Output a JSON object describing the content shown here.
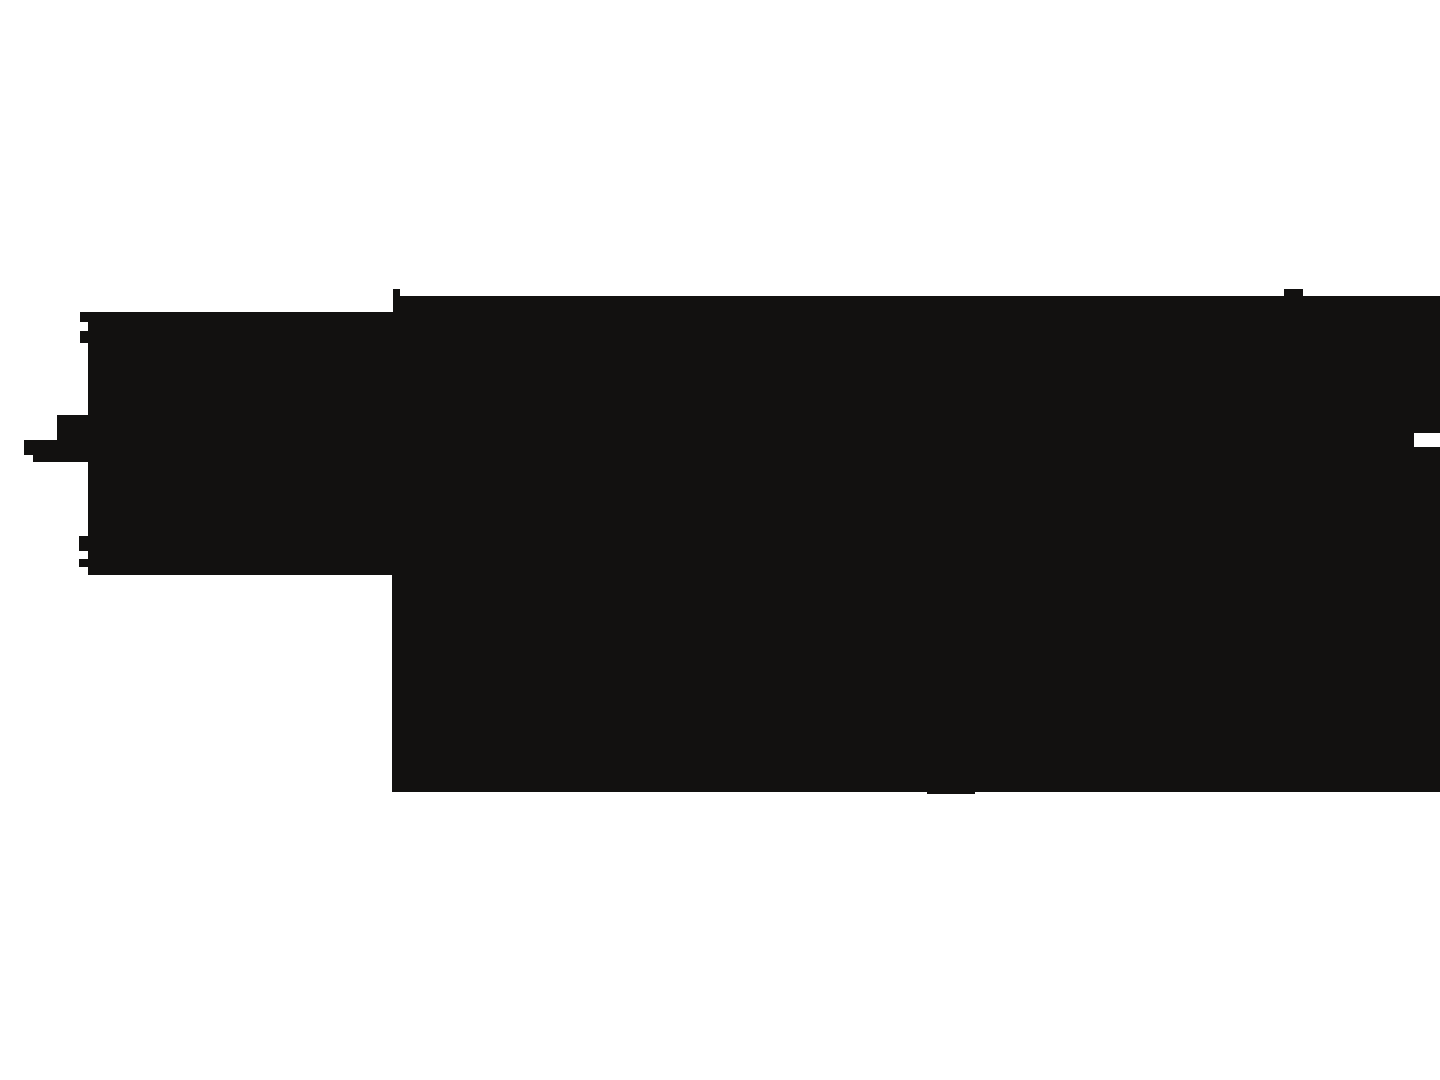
{
  "canvas": {
    "width": 1440,
    "height": 1080,
    "background_color": "#ffffff"
  },
  "silhouette": {
    "name": "black-silhouette",
    "fill_color": "#121110",
    "points": [
      [
        393,
        289
      ],
      [
        400,
        289
      ],
      [
        400,
        296
      ],
      [
        1284,
        296
      ],
      [
        1284,
        289
      ],
      [
        1303,
        289
      ],
      [
        1303,
        296
      ],
      [
        1440,
        296
      ],
      [
        1440,
        433
      ],
      [
        1414,
        433
      ],
      [
        1414,
        447
      ],
      [
        1440,
        447
      ],
      [
        1440,
        792
      ],
      [
        975,
        792
      ],
      [
        975,
        794
      ],
      [
        927,
        794
      ],
      [
        927,
        792
      ],
      [
        392,
        792
      ],
      [
        392,
        575
      ],
      [
        88,
        575
      ],
      [
        88,
        567
      ],
      [
        79,
        567
      ],
      [
        79,
        559
      ],
      [
        88,
        559
      ],
      [
        88,
        551
      ],
      [
        79,
        551
      ],
      [
        79,
        536
      ],
      [
        88,
        536
      ],
      [
        88,
        462
      ],
      [
        33,
        462
      ],
      [
        33,
        455
      ],
      [
        24,
        455
      ],
      [
        24,
        440
      ],
      [
        57,
        440
      ],
      [
        57,
        415
      ],
      [
        88,
        415
      ],
      [
        88,
        343
      ],
      [
        80,
        343
      ],
      [
        80,
        331
      ],
      [
        88,
        331
      ],
      [
        88,
        322
      ],
      [
        80,
        322
      ],
      [
        80,
        312
      ],
      [
        393,
        312
      ]
    ]
  }
}
